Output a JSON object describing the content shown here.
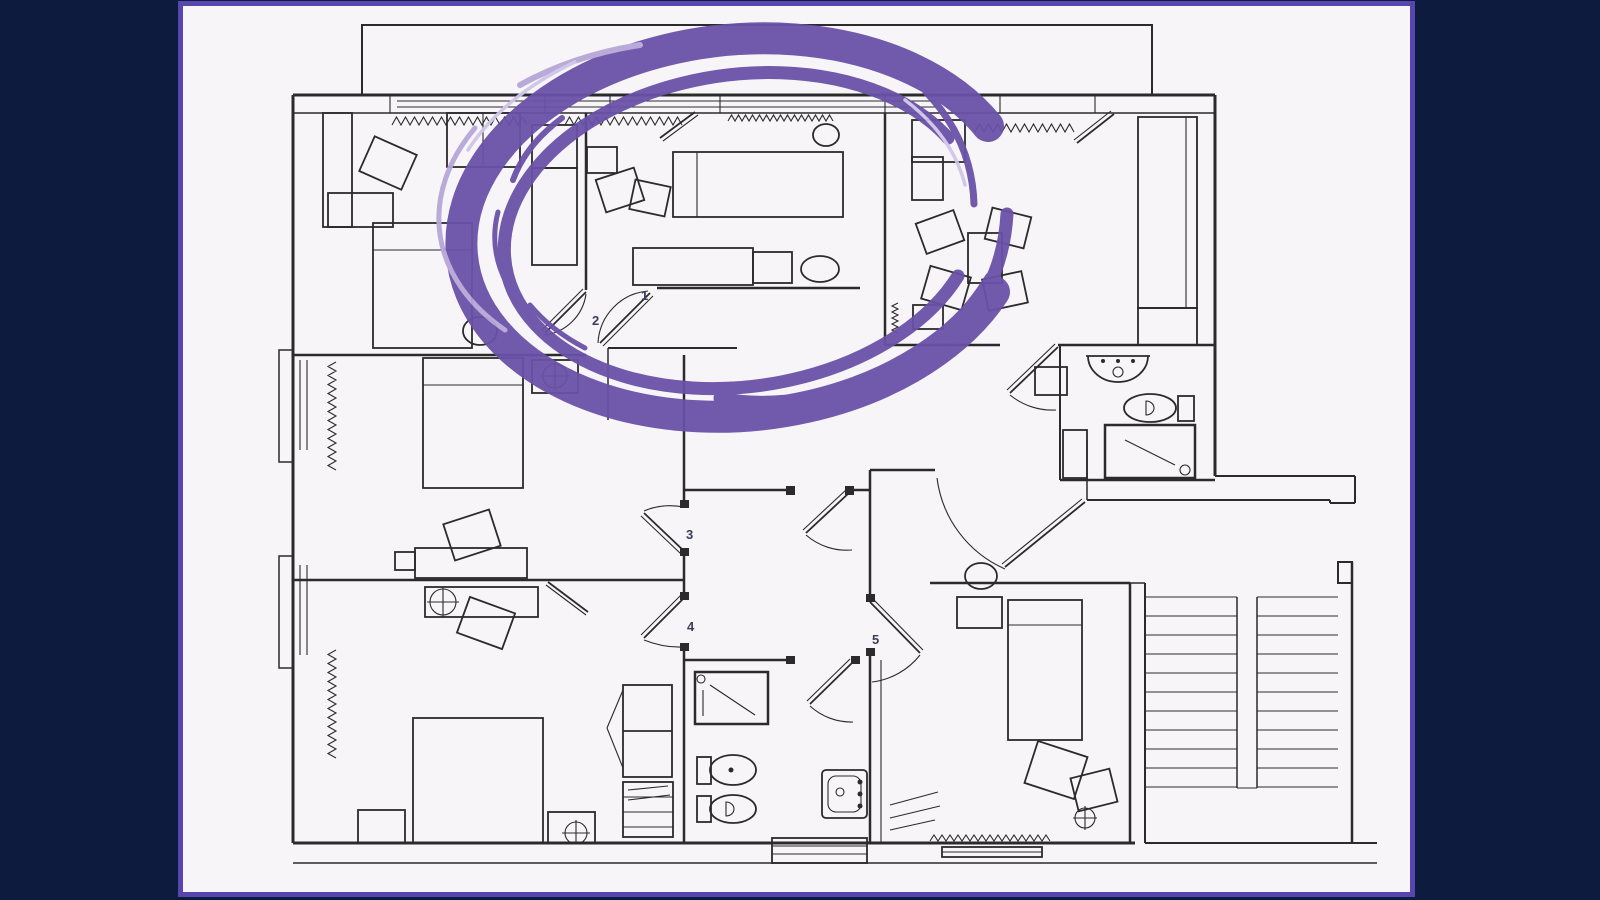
{
  "scene": {
    "description": "floor plan slide with hand-drawn circle annotation",
    "background_color": "#0d1c3e",
    "panel_color": "#f7f5f8",
    "panel_border_color": "#5646ae",
    "line_color": "#2b2b2b"
  },
  "annotation": {
    "type": "hand-drawn-brush-circle",
    "color": "#6a51a8",
    "highlight_color": "#b6a7d8",
    "streak_color": "#cfc5e8"
  },
  "plan": {
    "label_color": "#3a3f55",
    "room_labels": [
      {
        "text": "1"
      },
      {
        "text": "2"
      },
      {
        "text": "3"
      },
      {
        "text": "4"
      },
      {
        "text": "5"
      }
    ]
  }
}
